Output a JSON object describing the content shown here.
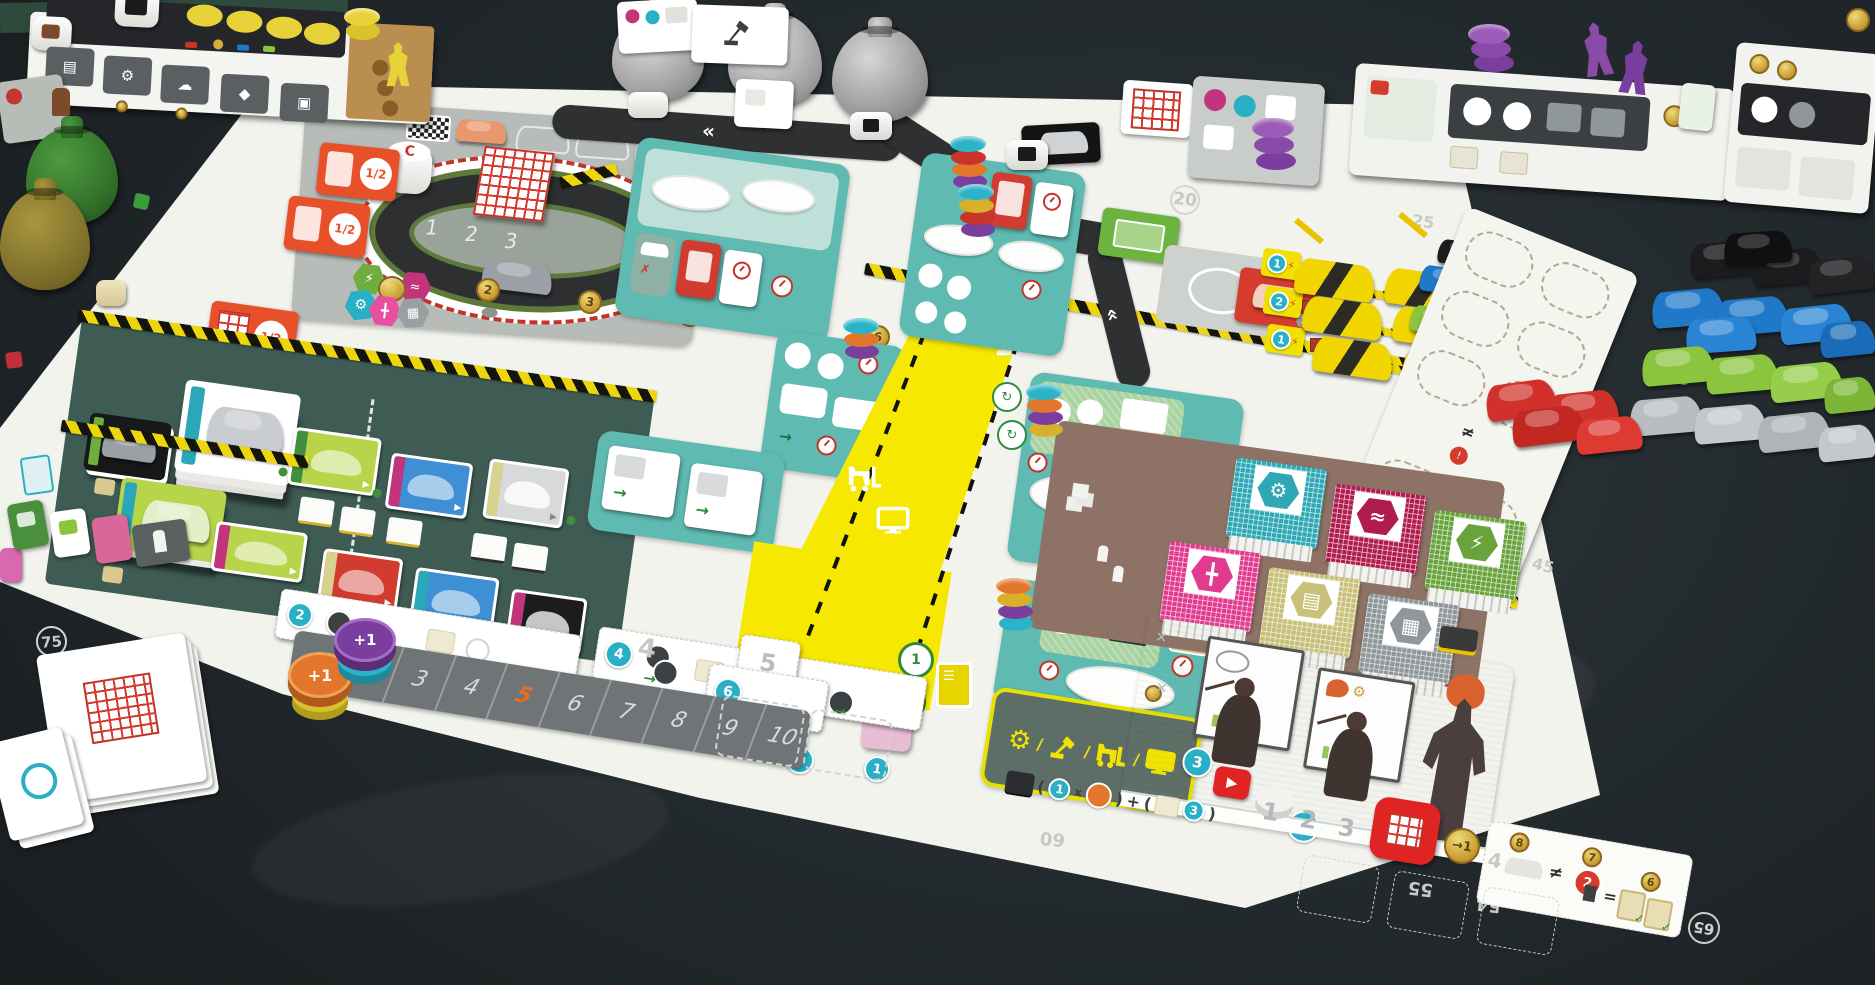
{
  "scene": {
    "name": "Kanban EV board game on dark table",
    "table_color": "#242b2e",
    "board_color": "#f3f3ee"
  },
  "board": {
    "corner_gear_token": "⚙",
    "test_track": {
      "logo": "C",
      "spaces": [
        "1",
        "2",
        "3"
      ]
    },
    "divider_coins": [
      "2",
      "3",
      "4",
      "5",
      "6"
    ],
    "meeting_card_label": "1/2",
    "upgrade_hexes": [
      "⚡",
      "≈",
      "⚙",
      "╋",
      "▦"
    ],
    "speed_track": {
      "cells": [
        "1",
        "2",
        "3",
        "4",
        "5",
        "6",
        "7",
        "8",
        "9",
        "10"
      ],
      "highlighted": "5",
      "faint_lane": "4",
      "faint_space": "5"
    },
    "demand_badges": {
      "left": [
        "2",
        "1"
      ],
      "mid": [
        "4",
        "2",
        "1"
      ],
      "right": [
        "6",
        "3",
        "1"
      ]
    },
    "logistics": {
      "bottom_circles": [
        "1",
        "2"
      ],
      "plus_tile": "+1",
      "cross": "✗"
    },
    "assembly": {
      "x_one": "x1",
      "plus_tile": "+1"
    },
    "warehouse": {
      "shift_tags": [
        "1",
        "2",
        "1"
      ],
      "neq": "≠"
    },
    "rnd_parts": [
      {
        "name": "engine",
        "color": "#2fa8b5",
        "glyph": "⚙"
      },
      {
        "name": "performance",
        "color": "#b01c4d",
        "glyph": "≈"
      },
      {
        "name": "battery",
        "color": "#69a33c",
        "glyph": "⚡"
      },
      {
        "name": "chassis",
        "color": "#e23a8e",
        "glyph": "╋"
      },
      {
        "name": "interior",
        "color": "#d8d28f",
        "glyph": "▤"
      },
      {
        "name": "electronics",
        "color": "#8f979a",
        "glyph": "▦"
      }
    ],
    "meeting_room": {
      "badge_left": "3",
      "badge_right": "4"
    },
    "score_track": {
      "top": [
        "10",
        "20",
        "25"
      ],
      "right": [
        "35",
        "45"
      ],
      "bottom": [
        "55",
        "54",
        "60",
        "65"
      ],
      "left": [
        "70",
        "75"
      ]
    },
    "bottom_bar": {
      "spaces": [
        "1",
        "2",
        "3"
      ],
      "coin_arrow": "→1",
      "cert": {
        "coin_a": "8",
        "coin_b": "7",
        "coin_c": "6",
        "faint_num": "4",
        "neq": "≠",
        "eq": "=",
        "red_badge": "2"
      }
    },
    "formula": {
      "badge_a": "1",
      "badge_b": "3",
      "times": "x",
      "plus": "+"
    }
  },
  "pieces": {
    "plus_token_label": "+1",
    "disc_colors": [
      "#2bb3c9",
      "#e2762a",
      "#7a3f9e",
      "#d8b02a",
      "#c9342b"
    ],
    "purple": "#8a4aa8",
    "yellow_player": "#e8d23a",
    "car_colors": {
      "black": "#1c1c1e",
      "blue": "#1f78c8",
      "green": "#8bc53f",
      "gray": "#b9bdc1",
      "red": "#d1312a",
      "yellow_cover": "#f0d500"
    },
    "bag_counts": {
      "gray": 3,
      "green": 1,
      "olive": 1
    },
    "car_counts": {
      "black": 4,
      "blue": 5,
      "green": 4,
      "gray": 4,
      "red": 4
    }
  },
  "player_boards": {
    "left": {
      "slot_icons": [
        "▤",
        "⚙",
        "☁",
        "◆",
        "▣"
      ]
    },
    "right": {
      "note": "opponent boards"
    }
  }
}
